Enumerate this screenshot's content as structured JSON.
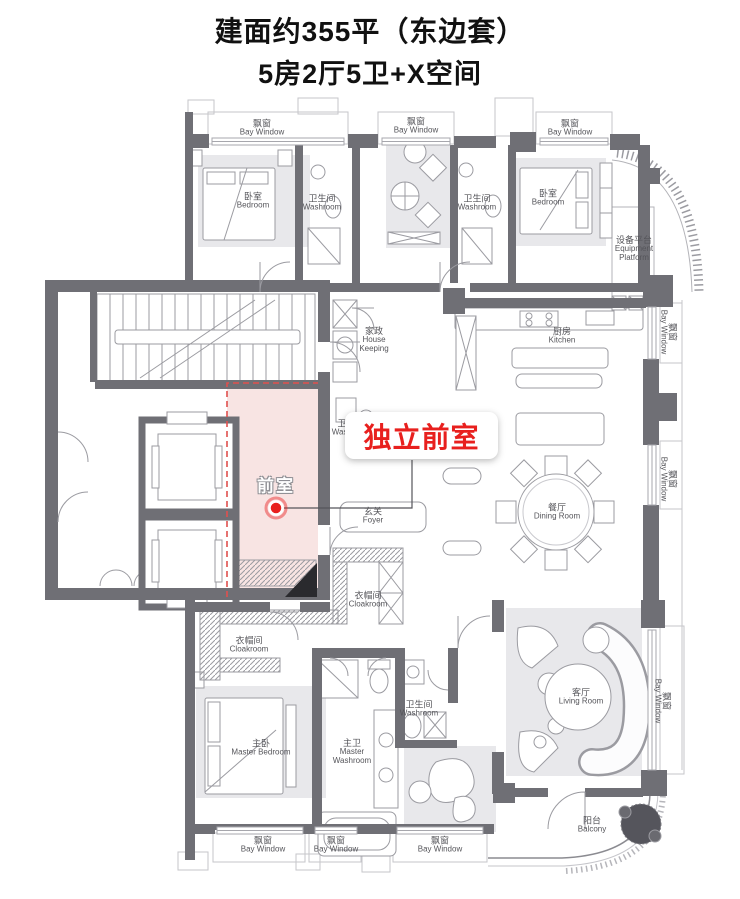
{
  "header": {
    "title_line1": "建面约355平（东边套）",
    "title_line2": "5房2厅5卫+X空间"
  },
  "annotation": {
    "label": "独立前室",
    "room_label": "前室"
  },
  "colors": {
    "accent_red": "#e8201e",
    "highlight_pink": "#f8e4e3",
    "dashed_red": "#e0504e"
  },
  "rooms": {
    "bedroom": {
      "zh": "卧室",
      "en": "Bedroom"
    },
    "washroom": {
      "zh": "卫生间",
      "en": "Washroom"
    },
    "bay_window": {
      "zh": "飘窗",
      "en": "Bay Window"
    },
    "equipment_platform": {
      "zh": "设备平台",
      "en": "Equipment Platform"
    },
    "house_keeping": {
      "zh": "家政",
      "en": "House Keeping"
    },
    "kitchen": {
      "zh": "厨房",
      "en": "Kitchen"
    },
    "foyer": {
      "zh": "玄关",
      "en": "Foyer"
    },
    "dining_room": {
      "zh": "餐厅",
      "en": "Dining Room"
    },
    "cloakroom": {
      "zh": "衣帽间",
      "en": "Cloakroom"
    },
    "master_bedroom": {
      "zh": "主卧",
      "en": "Master Bedroom"
    },
    "master_washroom": {
      "zh": "主卫",
      "en": "Master Washroom"
    },
    "living_room": {
      "zh": "客厅",
      "en": "Living Room"
    },
    "balcony": {
      "zh": "阳台",
      "en": "Balcony"
    }
  }
}
